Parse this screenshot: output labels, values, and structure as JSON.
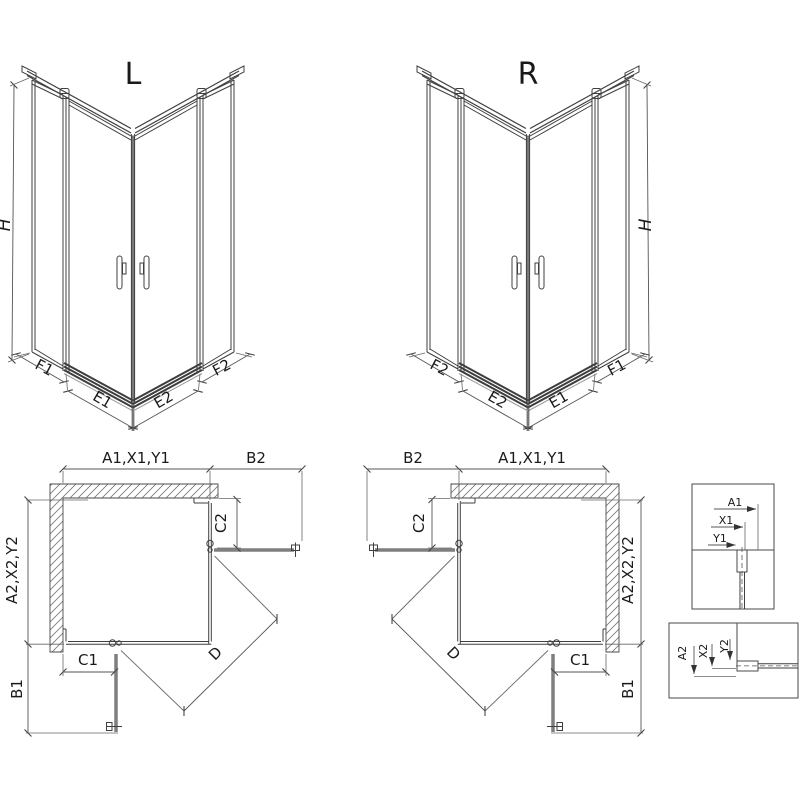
{
  "document": {
    "type": "shower-enclosure-dimension-drawing",
    "variants": [
      "L",
      "R"
    ]
  },
  "colors": {
    "background": "#ffffff",
    "line": "#3f3f3f",
    "dimension": "#555555",
    "open_door": "#7f7f7f",
    "hatch": "#777777",
    "text": "#1a1a1a"
  },
  "iso_left": {
    "title": "L",
    "dims": {
      "h": "H",
      "f1": "F1",
      "e1": "E1",
      "e2": "E2",
      "f2": "F2"
    }
  },
  "iso_right": {
    "title": "R",
    "dims": {
      "h": "H",
      "f1": "F1",
      "e1": "E1",
      "e2": "E2",
      "f2": "F2"
    }
  },
  "plan_left": {
    "dims": {
      "width_top": "A1,X1,Y1",
      "b2": "B2",
      "c2": "C2",
      "depth_side": "A2,X2,Y2",
      "c1": "C1",
      "b1": "B1",
      "d": "D"
    }
  },
  "plan_right": {
    "dims": {
      "width_top": "A1,X1,Y1",
      "b2": "B2",
      "c2": "C2",
      "depth_side": "A2,X2,Y2",
      "c1": "C1",
      "b1": "B1",
      "d": "D"
    }
  },
  "detail_top": {
    "dims": {
      "a1": "A1",
      "x1": "X1",
      "y1": "Y1"
    }
  },
  "detail_bottom": {
    "dims": {
      "a2": "A2",
      "x2": "X2",
      "y2": "Y2"
    }
  }
}
